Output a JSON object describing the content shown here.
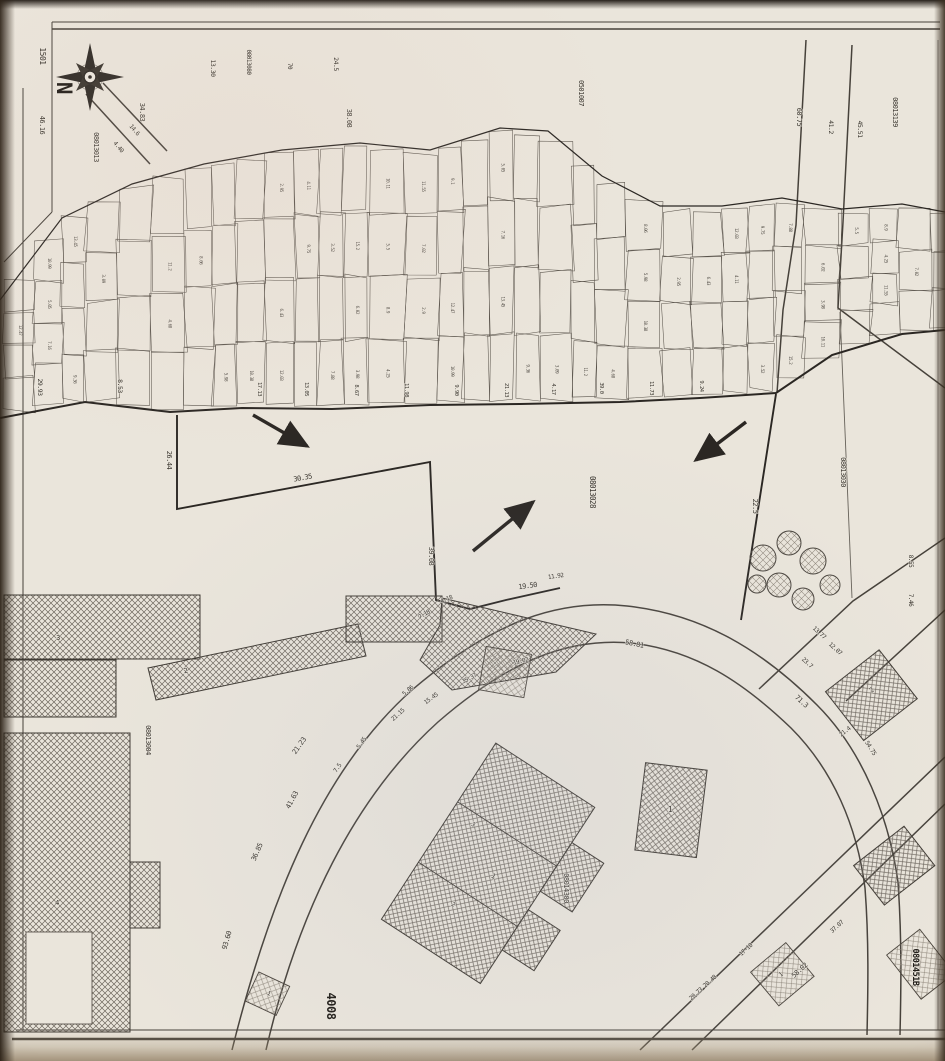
{
  "map": {
    "type": "scanned cadastral plat map",
    "north_label": "N",
    "sheet_number": "1501",
    "road_number": "4008",
    "parcel_ids": {
      "northwest": "08013013",
      "north_strip": "08013080",
      "north_center": "0501007",
      "northeast": "08013139",
      "center": "08013028",
      "east": "08013030",
      "west_block": "08013004",
      "south_block": "08014300",
      "southeast_bold": "0801451B"
    },
    "measurements": [
      {
        "t": "46.16",
        "x": 40,
        "y": 125,
        "r": 90,
        "s": 7
      },
      {
        "t": "34.83",
        "x": 140,
        "y": 112,
        "r": 90,
        "s": 7
      },
      {
        "t": "13.30",
        "x": 211,
        "y": 68,
        "r": 90,
        "s": 6.5
      },
      {
        "t": "70",
        "x": 288,
        "y": 66,
        "r": 90,
        "s": 6
      },
      {
        "t": "24.5",
        "x": 334,
        "y": 64,
        "r": 90,
        "s": 6.5
      },
      {
        "t": "38.08",
        "x": 347,
        "y": 118,
        "r": 90,
        "s": 7
      },
      {
        "t": "60.75",
        "x": 797,
        "y": 117,
        "r": 90,
        "s": 7
      },
      {
        "t": "41.2",
        "x": 829,
        "y": 127,
        "r": 90,
        "s": 6.5
      },
      {
        "t": "45.51",
        "x": 858,
        "y": 129,
        "r": 90,
        "s": 6.5
      },
      {
        "t": "14.6",
        "x": 133,
        "y": 131,
        "r": 50,
        "s": 6
      },
      {
        "t": "4.40",
        "x": 117,
        "y": 148,
        "r": 50,
        "s": 6
      },
      {
        "t": "29.93",
        "x": 38,
        "y": 387,
        "r": 90,
        "s": 6.5
      },
      {
        "t": "8.53",
        "x": 118,
        "y": 386,
        "r": 90,
        "s": 6.5
      },
      {
        "t": "26.44",
        "x": 167,
        "y": 460,
        "r": 90,
        "s": 7
      },
      {
        "t": "30.35",
        "x": 303,
        "y": 480,
        "r": -10,
        "s": 7
      },
      {
        "t": "39.08",
        "x": 429,
        "y": 556,
        "r": 90,
        "s": 7
      },
      {
        "t": "22.5",
        "x": 753,
        "y": 506,
        "r": 90,
        "s": 7
      },
      {
        "t": "8.55",
        "x": 909,
        "y": 561,
        "r": 90,
        "s": 6
      },
      {
        "t": "7.46",
        "x": 909,
        "y": 600,
        "r": 90,
        "s": 6
      },
      {
        "t": "17.13",
        "x": 258,
        "y": 389,
        "r": 90,
        "s": 5.5
      },
      {
        "t": "13.05",
        "x": 305,
        "y": 389,
        "r": 90,
        "s": 5.5
      },
      {
        "t": "8.67",
        "x": 355,
        "y": 390,
        "r": 90,
        "s": 5.5
      },
      {
        "t": "11.98",
        "x": 405,
        "y": 390,
        "r": 90,
        "s": 5.5
      },
      {
        "t": "9.90",
        "x": 455,
        "y": 390,
        "r": 90,
        "s": 5.5
      },
      {
        "t": "21.13",
        "x": 505,
        "y": 390,
        "r": 90,
        "s": 5.5
      },
      {
        "t": "4.17",
        "x": 552,
        "y": 389,
        "r": 90,
        "s": 5.5
      },
      {
        "t": "39.0",
        "x": 600,
        "y": 388,
        "r": 90,
        "s": 5.5
      },
      {
        "t": "11.73",
        "x": 650,
        "y": 388,
        "r": 90,
        "s": 5.5
      },
      {
        "t": "9.24",
        "x": 700,
        "y": 386,
        "r": 90,
        "s": 5.5
      },
      {
        "t": "4.18",
        "x": 447,
        "y": 601,
        "r": -22,
        "s": 6
      },
      {
        "t": "7.18",
        "x": 425,
        "y": 616,
        "r": -30,
        "s": 6
      },
      {
        "t": "19.50",
        "x": 528,
        "y": 588,
        "r": -8,
        "s": 7
      },
      {
        "t": "11.92",
        "x": 556,
        "y": 578,
        "r": -8,
        "s": 6
      },
      {
        "t": "19.02",
        "x": 521,
        "y": 663,
        "r": -14,
        "s": 6
      },
      {
        "t": "35.37",
        "x": 470,
        "y": 680,
        "r": -28,
        "s": 6
      },
      {
        "t": "15.45",
        "x": 432,
        "y": 700,
        "r": -36,
        "s": 6
      },
      {
        "t": "5.86",
        "x": 409,
        "y": 692,
        "r": -40,
        "s": 6
      },
      {
        "t": "21.15",
        "x": 399,
        "y": 716,
        "r": -42,
        "s": 6
      },
      {
        "t": "58.81",
        "x": 634,
        "y": 646,
        "r": 12,
        "s": 7
      },
      {
        "t": "13.77",
        "x": 818,
        "y": 634,
        "r": 42,
        "s": 6
      },
      {
        "t": "12.07",
        "x": 834,
        "y": 650,
        "r": 42,
        "s": 6
      },
      {
        "t": "23.7",
        "x": 806,
        "y": 664,
        "r": 42,
        "s": 6
      },
      {
        "t": "71.3",
        "x": 800,
        "y": 703,
        "r": 42,
        "s": 7
      },
      {
        "t": "54.75",
        "x": 869,
        "y": 749,
        "r": 58,
        "s": 6
      },
      {
        "t": "21.4",
        "x": 846,
        "y": 733,
        "r": -38,
        "s": 6
      },
      {
        "t": "21.23",
        "x": 301,
        "y": 747,
        "r": -55,
        "s": 7
      },
      {
        "t": "7.5",
        "x": 339,
        "y": 769,
        "r": -55,
        "s": 6
      },
      {
        "t": "5.45",
        "x": 363,
        "y": 744,
        "r": -55,
        "s": 6
      },
      {
        "t": "41.63",
        "x": 294,
        "y": 801,
        "r": -62,
        "s": 7
      },
      {
        "t": "36.85",
        "x": 259,
        "y": 853,
        "r": -66,
        "s": 7
      },
      {
        "t": "93.60",
        "x": 229,
        "y": 941,
        "r": -74,
        "s": 7
      },
      {
        "t": "20.73 20.48",
        "x": 704,
        "y": 989,
        "r": -42,
        "s": 6
      },
      {
        "t": "17-10",
        "x": 747,
        "y": 951,
        "r": -42,
        "s": 6
      },
      {
        "t": "58.02",
        "x": 801,
        "y": 972,
        "r": -42,
        "s": 7
      },
      {
        "t": "37.07",
        "x": 838,
        "y": 928,
        "r": -42,
        "s": 6
      },
      {
        "t": "1",
        "x": 670,
        "y": 812,
        "r": 0,
        "s": 8
      },
      {
        "t": "2",
        "x": 873,
        "y": 692,
        "r": -38,
        "s": 7
      },
      {
        "t": "2",
        "x": 186,
        "y": 673,
        "r": -12,
        "s": 7
      },
      {
        "t": "3",
        "x": 58,
        "y": 640,
        "r": 0,
        "s": 7
      },
      {
        "t": "4",
        "x": 57,
        "y": 905,
        "r": 0,
        "s": 7
      },
      {
        "t": "1",
        "x": 492,
        "y": 878,
        "r": 33,
        "s": 7
      },
      {
        "t": "3",
        "x": 472,
        "y": 826,
        "r": 33,
        "s": 6
      },
      {
        "t": "2",
        "x": 452,
        "y": 906,
        "r": 33,
        "s": 6
      },
      {
        "t": "1",
        "x": 268,
        "y": 995,
        "r": 25,
        "s": 6
      },
      {
        "t": "1",
        "x": 782,
        "y": 976,
        "r": -40,
        "s": 6
      }
    ],
    "strip_cell_numbers": [
      "12.47",
      "10.99",
      "5.05",
      "7.16",
      "13.45",
      "9.36",
      "3.09",
      "11.2",
      "4.68",
      "8.06",
      "5.98",
      "10.38",
      "2.95",
      "6.43",
      "12.03",
      "4.11",
      "9.75",
      "3.52",
      "7.88",
      "15.2",
      "6.02",
      "3.98",
      "10.11",
      "5.5",
      "8.9",
      "4.25",
      "11.55",
      "7.02",
      "2.9",
      "9.1"
    ]
  }
}
